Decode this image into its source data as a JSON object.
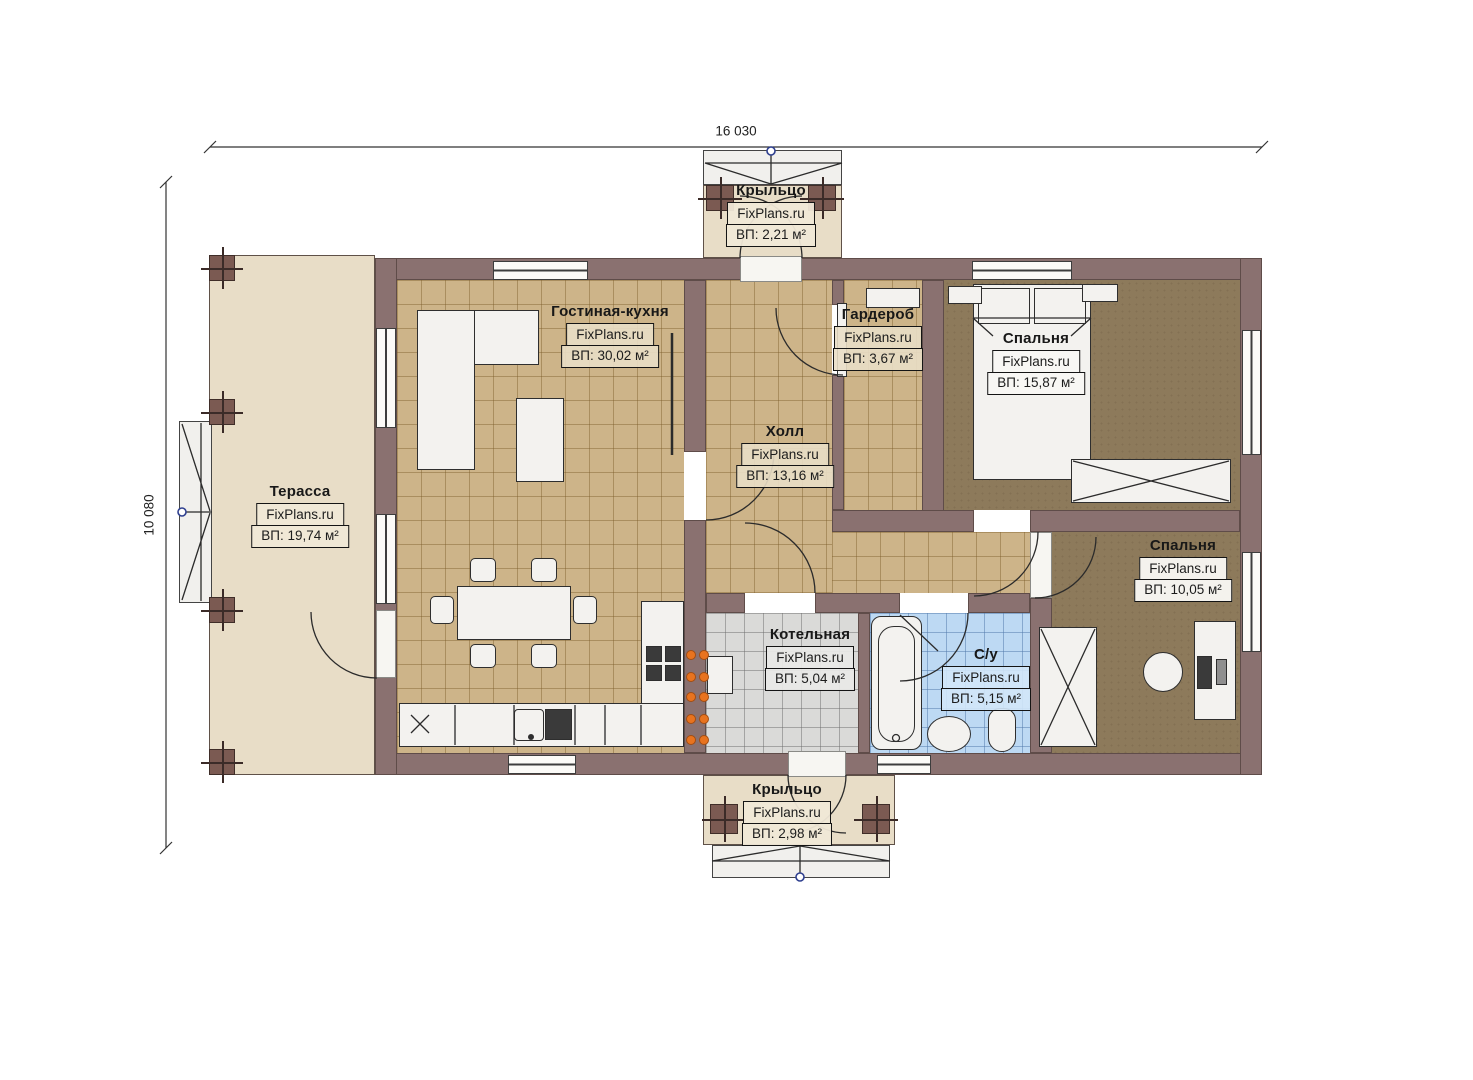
{
  "plan": {
    "watermark": "FixPlans.ru",
    "dimensions": {
      "width": "16 030",
      "height": "10 080"
    },
    "colors": {
      "wall": "#8a7170",
      "tile_tan": "#cdb489",
      "tile_gray": "#dadad8",
      "tile_blue": "#bdd9f3",
      "carpet": "#8d7a5b",
      "deck": "#e8ddc7",
      "burner": "#e8731f",
      "node_blue": "#2e3f8f"
    },
    "rooms": [
      {
        "id": "porch-top",
        "name": "Крыльцо",
        "brand": "FixPlans.ru",
        "area": "ВП: 2,21 м²"
      },
      {
        "id": "living-kitchen",
        "name": "Гостиная-кухня",
        "brand": "FixPlans.ru",
        "area": "ВП: 30,02 м²"
      },
      {
        "id": "wardrobe",
        "name": "Гардероб",
        "brand": "FixPlans.ru",
        "area": "ВП: 3,67 м²"
      },
      {
        "id": "bedroom-1",
        "name": "Спальня",
        "brand": "FixPlans.ru",
        "area": "ВП: 15,87 м²"
      },
      {
        "id": "hall",
        "name": "Холл",
        "brand": "FixPlans.ru",
        "area": "ВП: 13,16 м²"
      },
      {
        "id": "terrace",
        "name": "Терасса",
        "brand": "FixPlans.ru",
        "area": "ВП: 19,74 м²"
      },
      {
        "id": "bedroom-2",
        "name": "Спальня",
        "brand": "FixPlans.ru",
        "area": "ВП: 10,05 м²"
      },
      {
        "id": "boiler",
        "name": "Котельная",
        "brand": "FixPlans.ru",
        "area": "ВП: 5,04 м²"
      },
      {
        "id": "bathroom",
        "name": "С/у",
        "brand": "FixPlans.ru",
        "area": "ВП: 5,15 м²"
      },
      {
        "id": "porch-bottom",
        "name": "Крыльцо",
        "brand": "FixPlans.ru",
        "area": "ВП: 2,98 м²"
      }
    ]
  }
}
